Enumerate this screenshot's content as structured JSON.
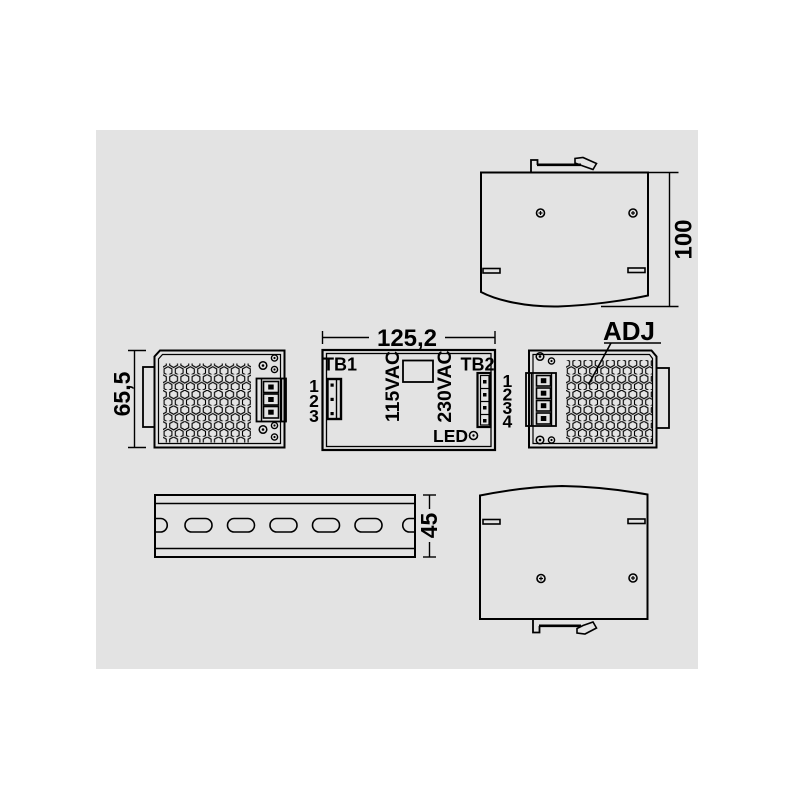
{
  "colors": {
    "background": "#ffffff",
    "panel": "#e3e3e3",
    "line": "#000000"
  },
  "dimensions": {
    "width_label": "125,2",
    "height_label": "100",
    "side_height_label": "65,5",
    "rail_height_label": "45"
  },
  "front_view": {
    "tb1_label": "TB1",
    "tb2_label": "TB2",
    "voltage_115_label": "115VAC",
    "voltage_230_label": "230VAC",
    "led_label": "LED"
  },
  "right_view": {
    "adj_label": "ADJ"
  },
  "tb1_pins": [
    "1",
    "2",
    "3"
  ],
  "tb2_pins": [
    "1",
    "2",
    "3",
    "4"
  ]
}
